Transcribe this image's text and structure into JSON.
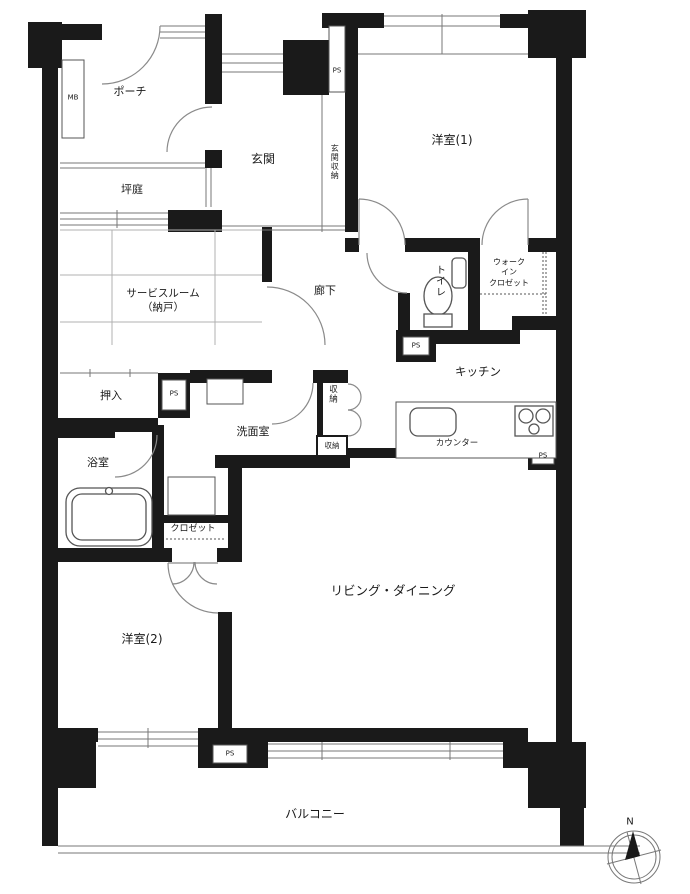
{
  "rooms": {
    "porch": "ポーチ",
    "meter_box": "MB",
    "tsubo_garden": "坪庭",
    "entrance": "玄関",
    "entrance_storage": "玄関収納",
    "western_room_1": "洋室(1)",
    "toilet": "トイレ",
    "wic_line1": "ウォーク",
    "wic_line2": "イン",
    "wic_line3": "クロゼット",
    "service_room_line1": "サービスルーム",
    "service_room_line2": "（納戸）",
    "hallway": "廊下",
    "oshiire": "押入",
    "washroom": "洗面室",
    "storage": "収納",
    "storage_small": "収納",
    "bathroom": "浴室",
    "closet": "クロゼット",
    "kitchen": "キッチン",
    "counter": "カウンター",
    "living_dining": "リビング・ダイニング",
    "western_room_2": "洋室(2)",
    "balcony": "バルコニー"
  },
  "labels": {
    "pipe_space": "PS",
    "north": "N"
  },
  "colors": {
    "wall": "#1a1a1a",
    "line": "#777777",
    "text": "#1a1a1a"
  }
}
